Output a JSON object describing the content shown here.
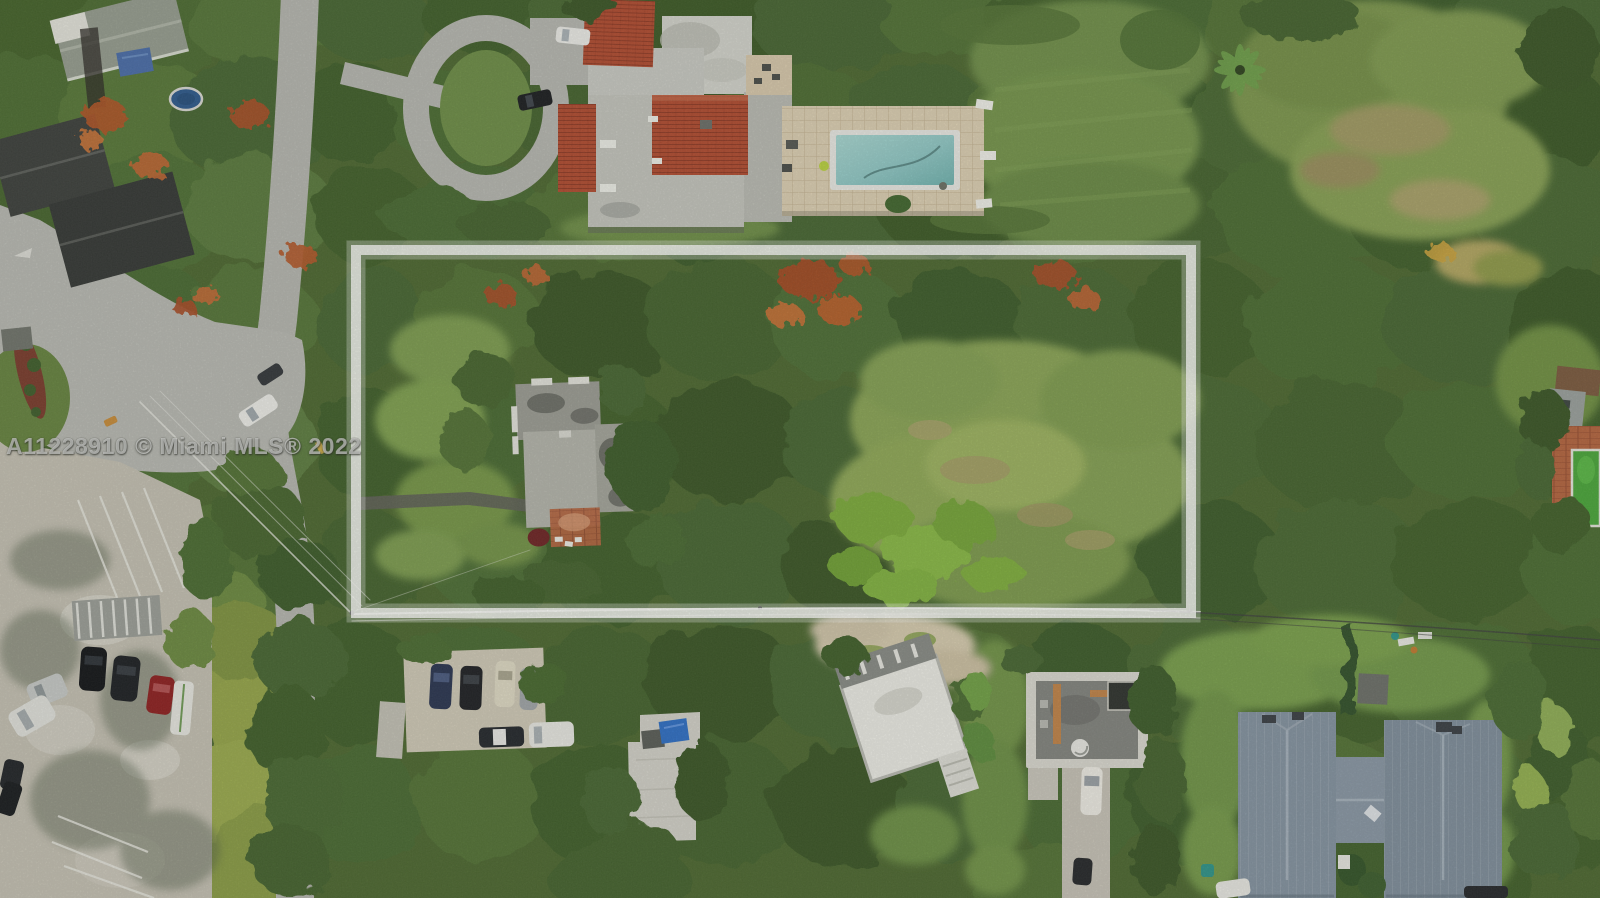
{
  "watermark": {
    "text": "A11228910 © Miami MLS® 2022",
    "color": "#ffffff",
    "opacity": 0.52
  },
  "palette": {
    "canopy_dark": "#3a5727",
    "canopy_mid": "#4a6a31",
    "canopy_light": "#5d7d40",
    "golden_foliage": "#97a74b",
    "flowering_orange": "#b35a2c",
    "lawn": "#8aa455",
    "meadow_tan": "#a49e66",
    "pavement": "#b5b6af",
    "parking_lot": "#c4c0b2",
    "roof_red_tile": "#b14c30",
    "roof_grey": "#c3c4bc",
    "roof_charcoal": "#3d403c",
    "metal_roof_blue_grey": "#8493a0",
    "pool_water": "#8fc7c4",
    "pool_deck": "#dccfb2",
    "green_pool": "#4aa63a",
    "terracotta_patio": "#b4653f",
    "blue_tarp": "#4a6da8",
    "boundary_white": "#ffffff",
    "mulch_red": "#7a3c2c"
  }
}
